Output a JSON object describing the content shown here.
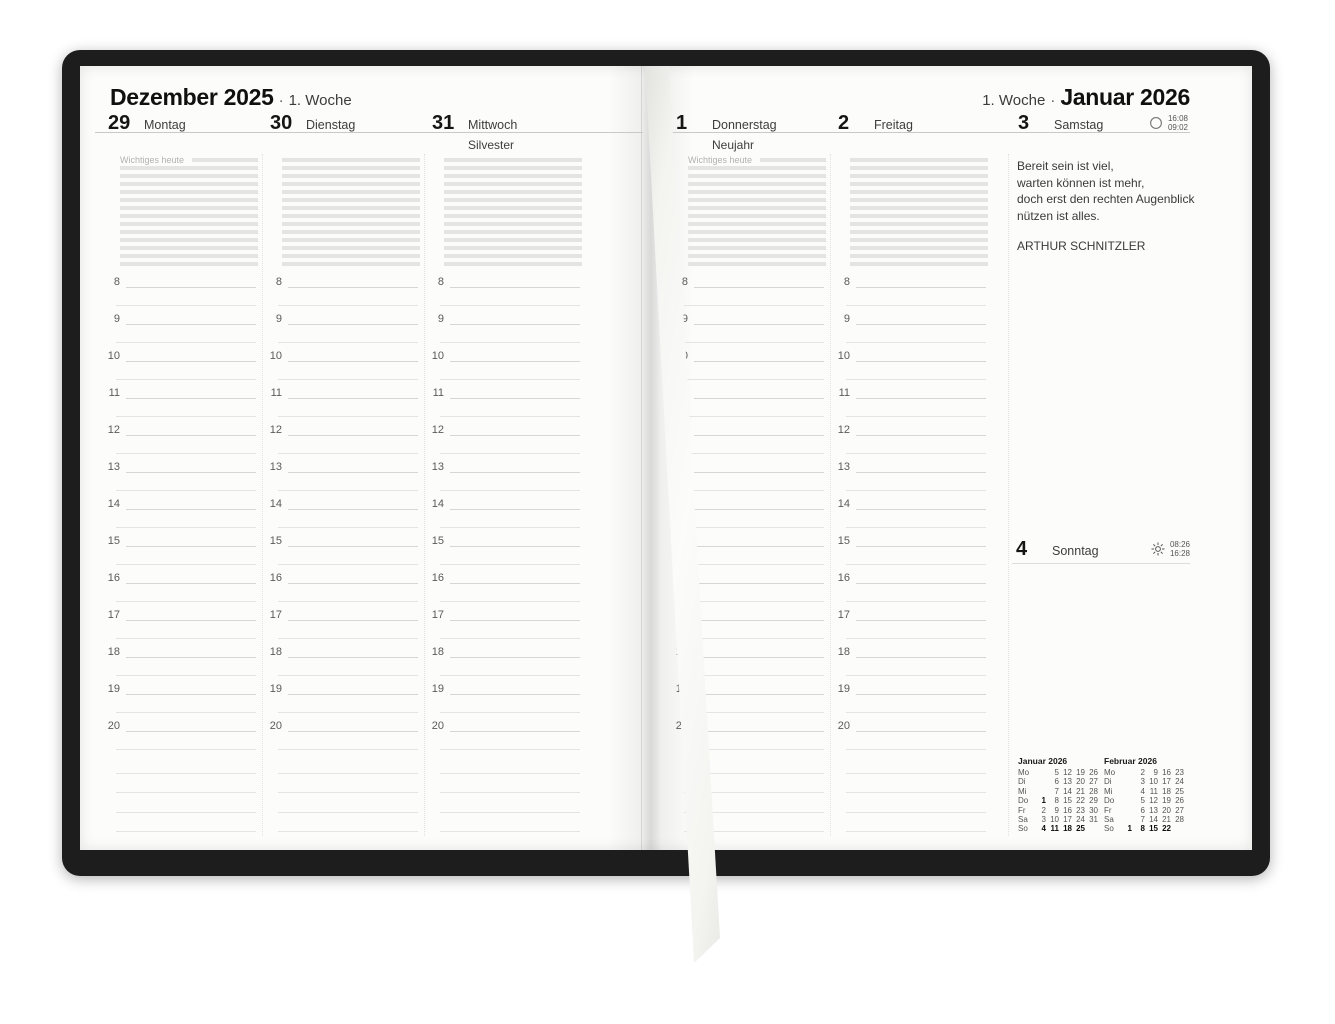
{
  "meta": {
    "item": "weekly planner spread photo",
    "cover_color": "#1d1d1d",
    "page_color": "#fcfcfb",
    "ribbon_color": "#f4f4f1"
  },
  "hours": [
    "8",
    "9",
    "10",
    "11",
    "12",
    "13",
    "14",
    "15",
    "16",
    "17",
    "18",
    "19",
    "20"
  ],
  "left_page": {
    "month_title": "Dezember 2025",
    "separator": "·",
    "week_label": "1. Woche",
    "notes_label": "Wichtiges heute",
    "days": [
      {
        "number": "29",
        "name": "Montag",
        "holiday": "",
        "has_notes_label": true
      },
      {
        "number": "30",
        "name": "Dienstag",
        "holiday": ""
      },
      {
        "number": "31",
        "name": "Mittwoch",
        "holiday": "Silvester"
      }
    ]
  },
  "right_page": {
    "week_label": "1. Woche",
    "separator": "·",
    "month_title": "Januar 2026",
    "notes_label": "Wichtiges heute",
    "days": [
      {
        "number": "1",
        "name": "Donnerstag",
        "holiday": "Neujahr",
        "has_notes_label": true
      },
      {
        "number": "2",
        "name": "Freitag",
        "holiday": ""
      },
      {
        "number": "3",
        "name": "Samstag",
        "holiday": "",
        "quote_column": true,
        "astro_icon": "moon-circle-icon",
        "moon_times": [
          "16:08",
          "09:02"
        ]
      }
    ],
    "quote": {
      "lines": [
        "Bereit sein ist viel,",
        "warten können ist mehr,",
        "doch erst den rechten Augenblick",
        "nützen ist alles."
      ],
      "author": "ARTHUR SCHNITZLER"
    },
    "sunday": {
      "number": "4",
      "name": "Sonntag",
      "astro_icon": "sun-icon",
      "sun_times": [
        "08:26",
        "16:28"
      ]
    },
    "mini_calendars": [
      {
        "title": "Januar 2026",
        "rows": [
          {
            "label": "Mo",
            "cells": [
              "",
              "5",
              "12",
              "19",
              "26"
            ],
            "bold": []
          },
          {
            "label": "Di",
            "cells": [
              "",
              "6",
              "13",
              "20",
              "27"
            ],
            "bold": []
          },
          {
            "label": "Mi",
            "cells": [
              "",
              "7",
              "14",
              "21",
              "28"
            ],
            "bold": []
          },
          {
            "label": "Do",
            "cells": [
              "1",
              "8",
              "15",
              "22",
              "29"
            ],
            "bold": [
              0
            ]
          },
          {
            "label": "Fr",
            "cells": [
              "2",
              "9",
              "16",
              "23",
              "30"
            ],
            "bold": []
          },
          {
            "label": "Sa",
            "cells": [
              "3",
              "10",
              "17",
              "24",
              "31"
            ],
            "bold": []
          },
          {
            "label": "So",
            "cells": [
              "4",
              "11",
              "18",
              "25",
              ""
            ],
            "bold": [
              0,
              1,
              2,
              3
            ]
          }
        ]
      },
      {
        "title": "Februar 2026",
        "rows": [
          {
            "label": "Mo",
            "cells": [
              "",
              "2",
              "9",
              "16",
              "23"
            ],
            "bold": []
          },
          {
            "label": "Di",
            "cells": [
              "",
              "3",
              "10",
              "17",
              "24"
            ],
            "bold": []
          },
          {
            "label": "Mi",
            "cells": [
              "",
              "4",
              "11",
              "18",
              "25"
            ],
            "bold": []
          },
          {
            "label": "Do",
            "cells": [
              "",
              "5",
              "12",
              "19",
              "26"
            ],
            "bold": []
          },
          {
            "label": "Fr",
            "cells": [
              "",
              "6",
              "13",
              "20",
              "27"
            ],
            "bold": []
          },
          {
            "label": "Sa",
            "cells": [
              "",
              "7",
              "14",
              "21",
              "28"
            ],
            "bold": []
          },
          {
            "label": "So",
            "cells": [
              "1",
              "8",
              "15",
              "22",
              ""
            ],
            "bold": [
              0,
              1,
              2,
              3
            ]
          }
        ]
      }
    ]
  }
}
